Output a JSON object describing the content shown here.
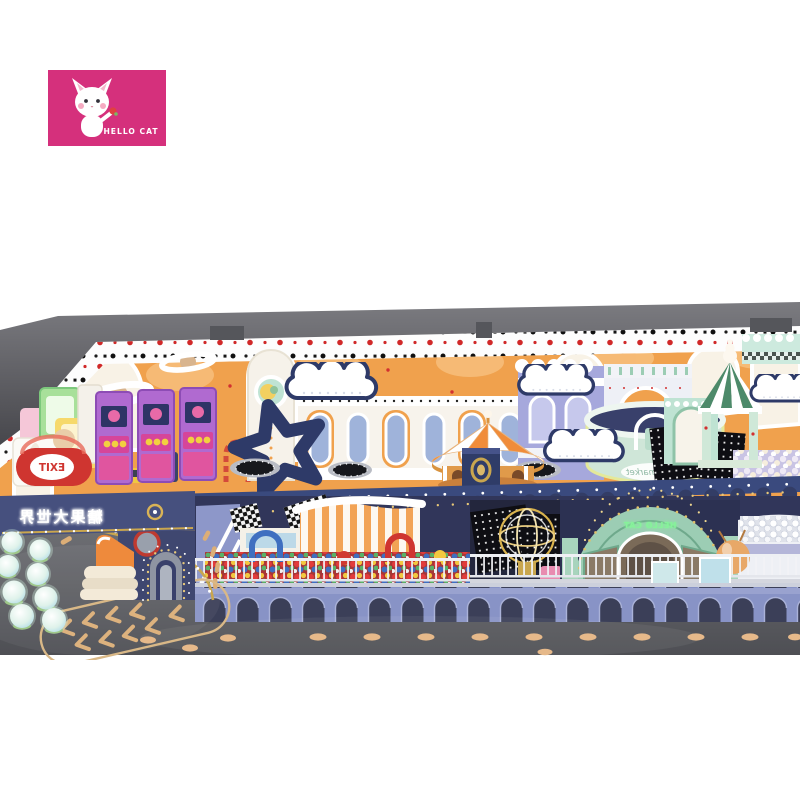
{
  "page": {
    "background": "#ffffff",
    "width": 800,
    "height": 800
  },
  "logo": {
    "brand": "HELLO CAT",
    "bg": "#d5307c",
    "flower_red": "#e04040"
  },
  "signs": {
    "exit": "EXIT",
    "market": "super market",
    "dome_neon": "HELLO CAT",
    "marquee_neon": "糖果大世界"
  },
  "palette": {
    "wall_orange": "#f0a14d",
    "cap_gray": "#5f6065",
    "trim_white": "#fdfdfd",
    "navy": "#2e3a68",
    "deck_navy": "#3a4a7e",
    "valance_navy": "#333d66",
    "facade_navy": "#46507e",
    "periwinkle": "#8893c6",
    "arch_opening": "#3b3f58",
    "mint": "#bfe3d3",
    "dome_green": "#9ccdb4",
    "gold": "#c9a64e",
    "floor_gray_top": "#6e6f74",
    "floor_gray_bottom": "#4e4f54",
    "floor_dot_tan": "#e6b98a",
    "red": "#cf3530",
    "arcade_purple": "#b06ad0",
    "arcade_pink": "#d6459a",
    "carousel_orange": "#f08c3a",
    "lavender": "#a6a8dc",
    "balloon_orange": "#e8a868",
    "neon_green": "#86f29a"
  }
}
